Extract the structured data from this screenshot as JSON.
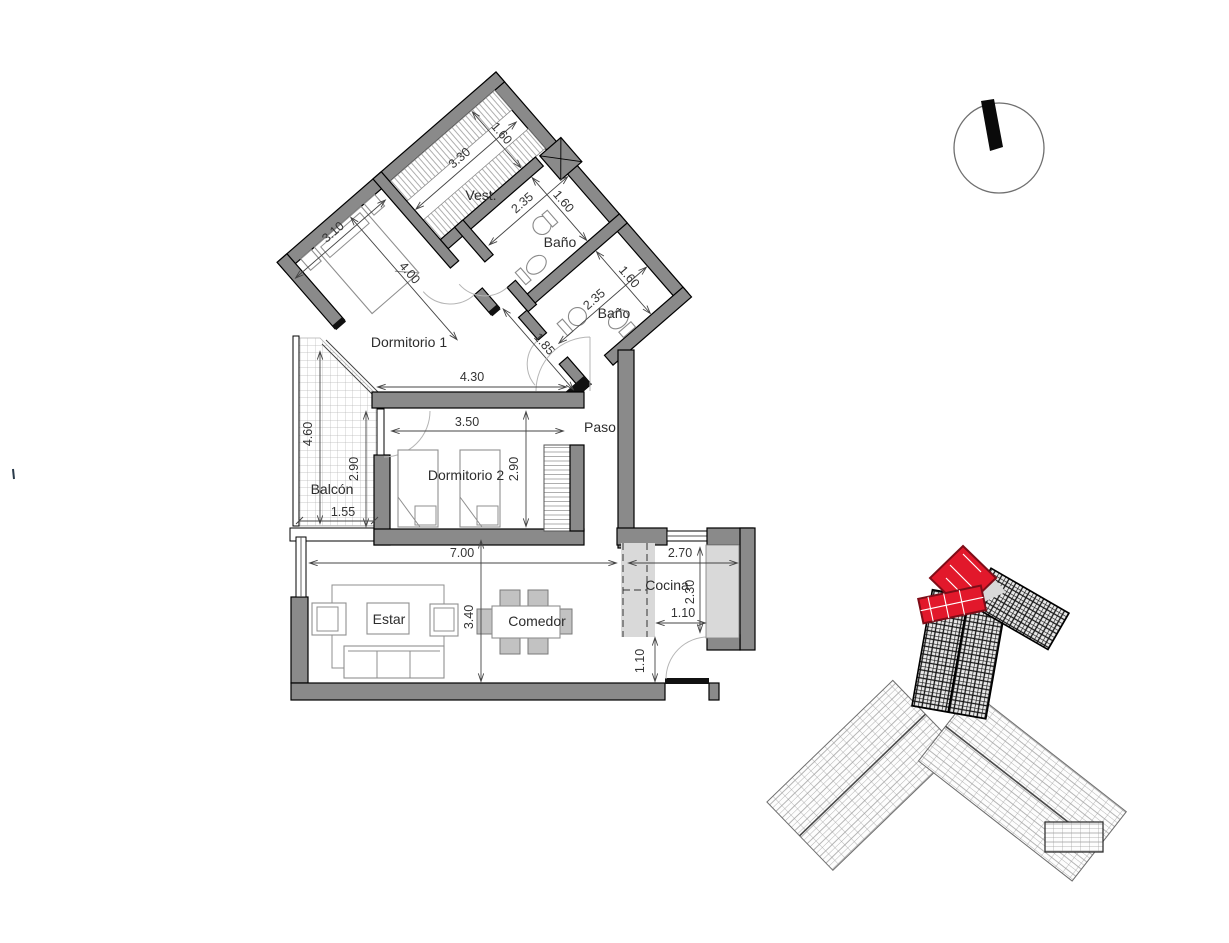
{
  "plan": {
    "rooms": {
      "vest": "Vest.",
      "bano_1": "Baño",
      "bano_2": "Baño",
      "dormitorio_1": "Dormitorio 1",
      "dormitorio_2": "Dormitorio 2",
      "paso": "Paso",
      "balcon": "Balcón",
      "estar": "Estar",
      "comedor": "Comedor",
      "cocina": "Cocina"
    },
    "dimensions": {
      "vest_length": "3.30",
      "vest_width": "1.60",
      "dorm1_depth": "3.10",
      "dorm1_width": "4.00",
      "bano1_depth": "2.35",
      "bano1_width": "1.60",
      "bano2_depth": "2.35",
      "bano2_width": "1.60",
      "hall_width": "1.85",
      "zone_width": "4.30",
      "dorm2_width": "3.50",
      "dorm2_depth_left": "2.90",
      "dorm2_depth_right": "2.90",
      "balcon_length": "4.60",
      "balcon_width": "1.55",
      "living_width": "7.00",
      "cocina_width": "2.70",
      "cocina_depth": "2.30",
      "cocina_pass": "1.10",
      "cocina_door": "1.10",
      "living_depth": "3.40"
    }
  },
  "icons": {
    "north_arrow": "north-arrow-icon",
    "key_plan": "site-key-plan"
  },
  "colors": {
    "wall_grey": "#8a8a8a",
    "counter_grey": "#d9d9d9",
    "highlight_red": "#e2182b",
    "line_dark": "#444444",
    "text": "#333333"
  }
}
